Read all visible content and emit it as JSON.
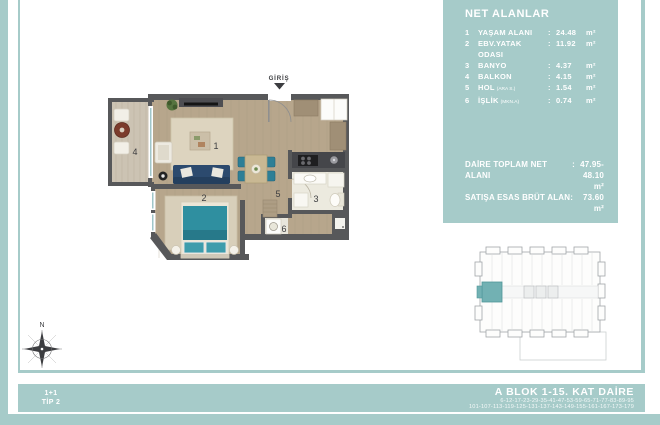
{
  "net_areas_panel": {
    "title": "NET ALANLAR",
    "rows": [
      {
        "no": "1",
        "label": "YAŞAM ALANI",
        "note": "",
        "sep": ":",
        "value": "24.48",
        "unit": "m²"
      },
      {
        "no": "2",
        "label": "EBV.YATAK ODASI",
        "note": "",
        "sep": ":",
        "value": "11.92",
        "unit": "m²"
      },
      {
        "no": "3",
        "label": "BANYO",
        "note": "",
        "sep": ":",
        "value": "4.37",
        "unit": "m²"
      },
      {
        "no": "4",
        "label": "BALKON",
        "note": "",
        "sep": ":",
        "value": "4.15",
        "unit": "m²"
      },
      {
        "no": "5",
        "label": "HOL",
        "note": "(ARA S.)",
        "sep": ":",
        "value": "1.54",
        "unit": "m²"
      },
      {
        "no": "6",
        "label": "İŞLİK",
        "note": "(MKN.A)",
        "sep": ":",
        "value": "0.74",
        "unit": "m²"
      }
    ],
    "total_net_label": "DAİRE TOPLAM NET ALANI",
    "total_net_sep": ":",
    "total_net_value": "47.95-48.10 m²",
    "gross_label": "SATIŞA ESAS BRÜT ALAN",
    "gross_sep": ":",
    "gross_value": "73.60 m²"
  },
  "floor_plan": {
    "entrance_label": "GİRİŞ",
    "rooms": {
      "living": "1",
      "bedroom": "2",
      "bathroom": "3",
      "balcony": "4",
      "hall": "5",
      "utility": "6"
    }
  },
  "compass": {
    "north_label": "N"
  },
  "footer": {
    "tip_line1": "1+1",
    "tip_line2": "TİP 2",
    "block_title": "A BLOK 1-15. KAT DAİRE",
    "units_line1": "6-12-17-23-29-35-41-47-53-59-65-71-77-83-89-95",
    "units_line2": "101-107-113-119-125-131-137-143-149-155-161-167-173-179"
  },
  "colors": {
    "teal": "#a6cbc9",
    "wall": "#57585a",
    "wood": "#b7a68c",
    "accent_teal": "#2f8fa0",
    "navy": "#2c4a6e",
    "highlight": "#72b1b3",
    "ink": "#3c3d40"
  }
}
